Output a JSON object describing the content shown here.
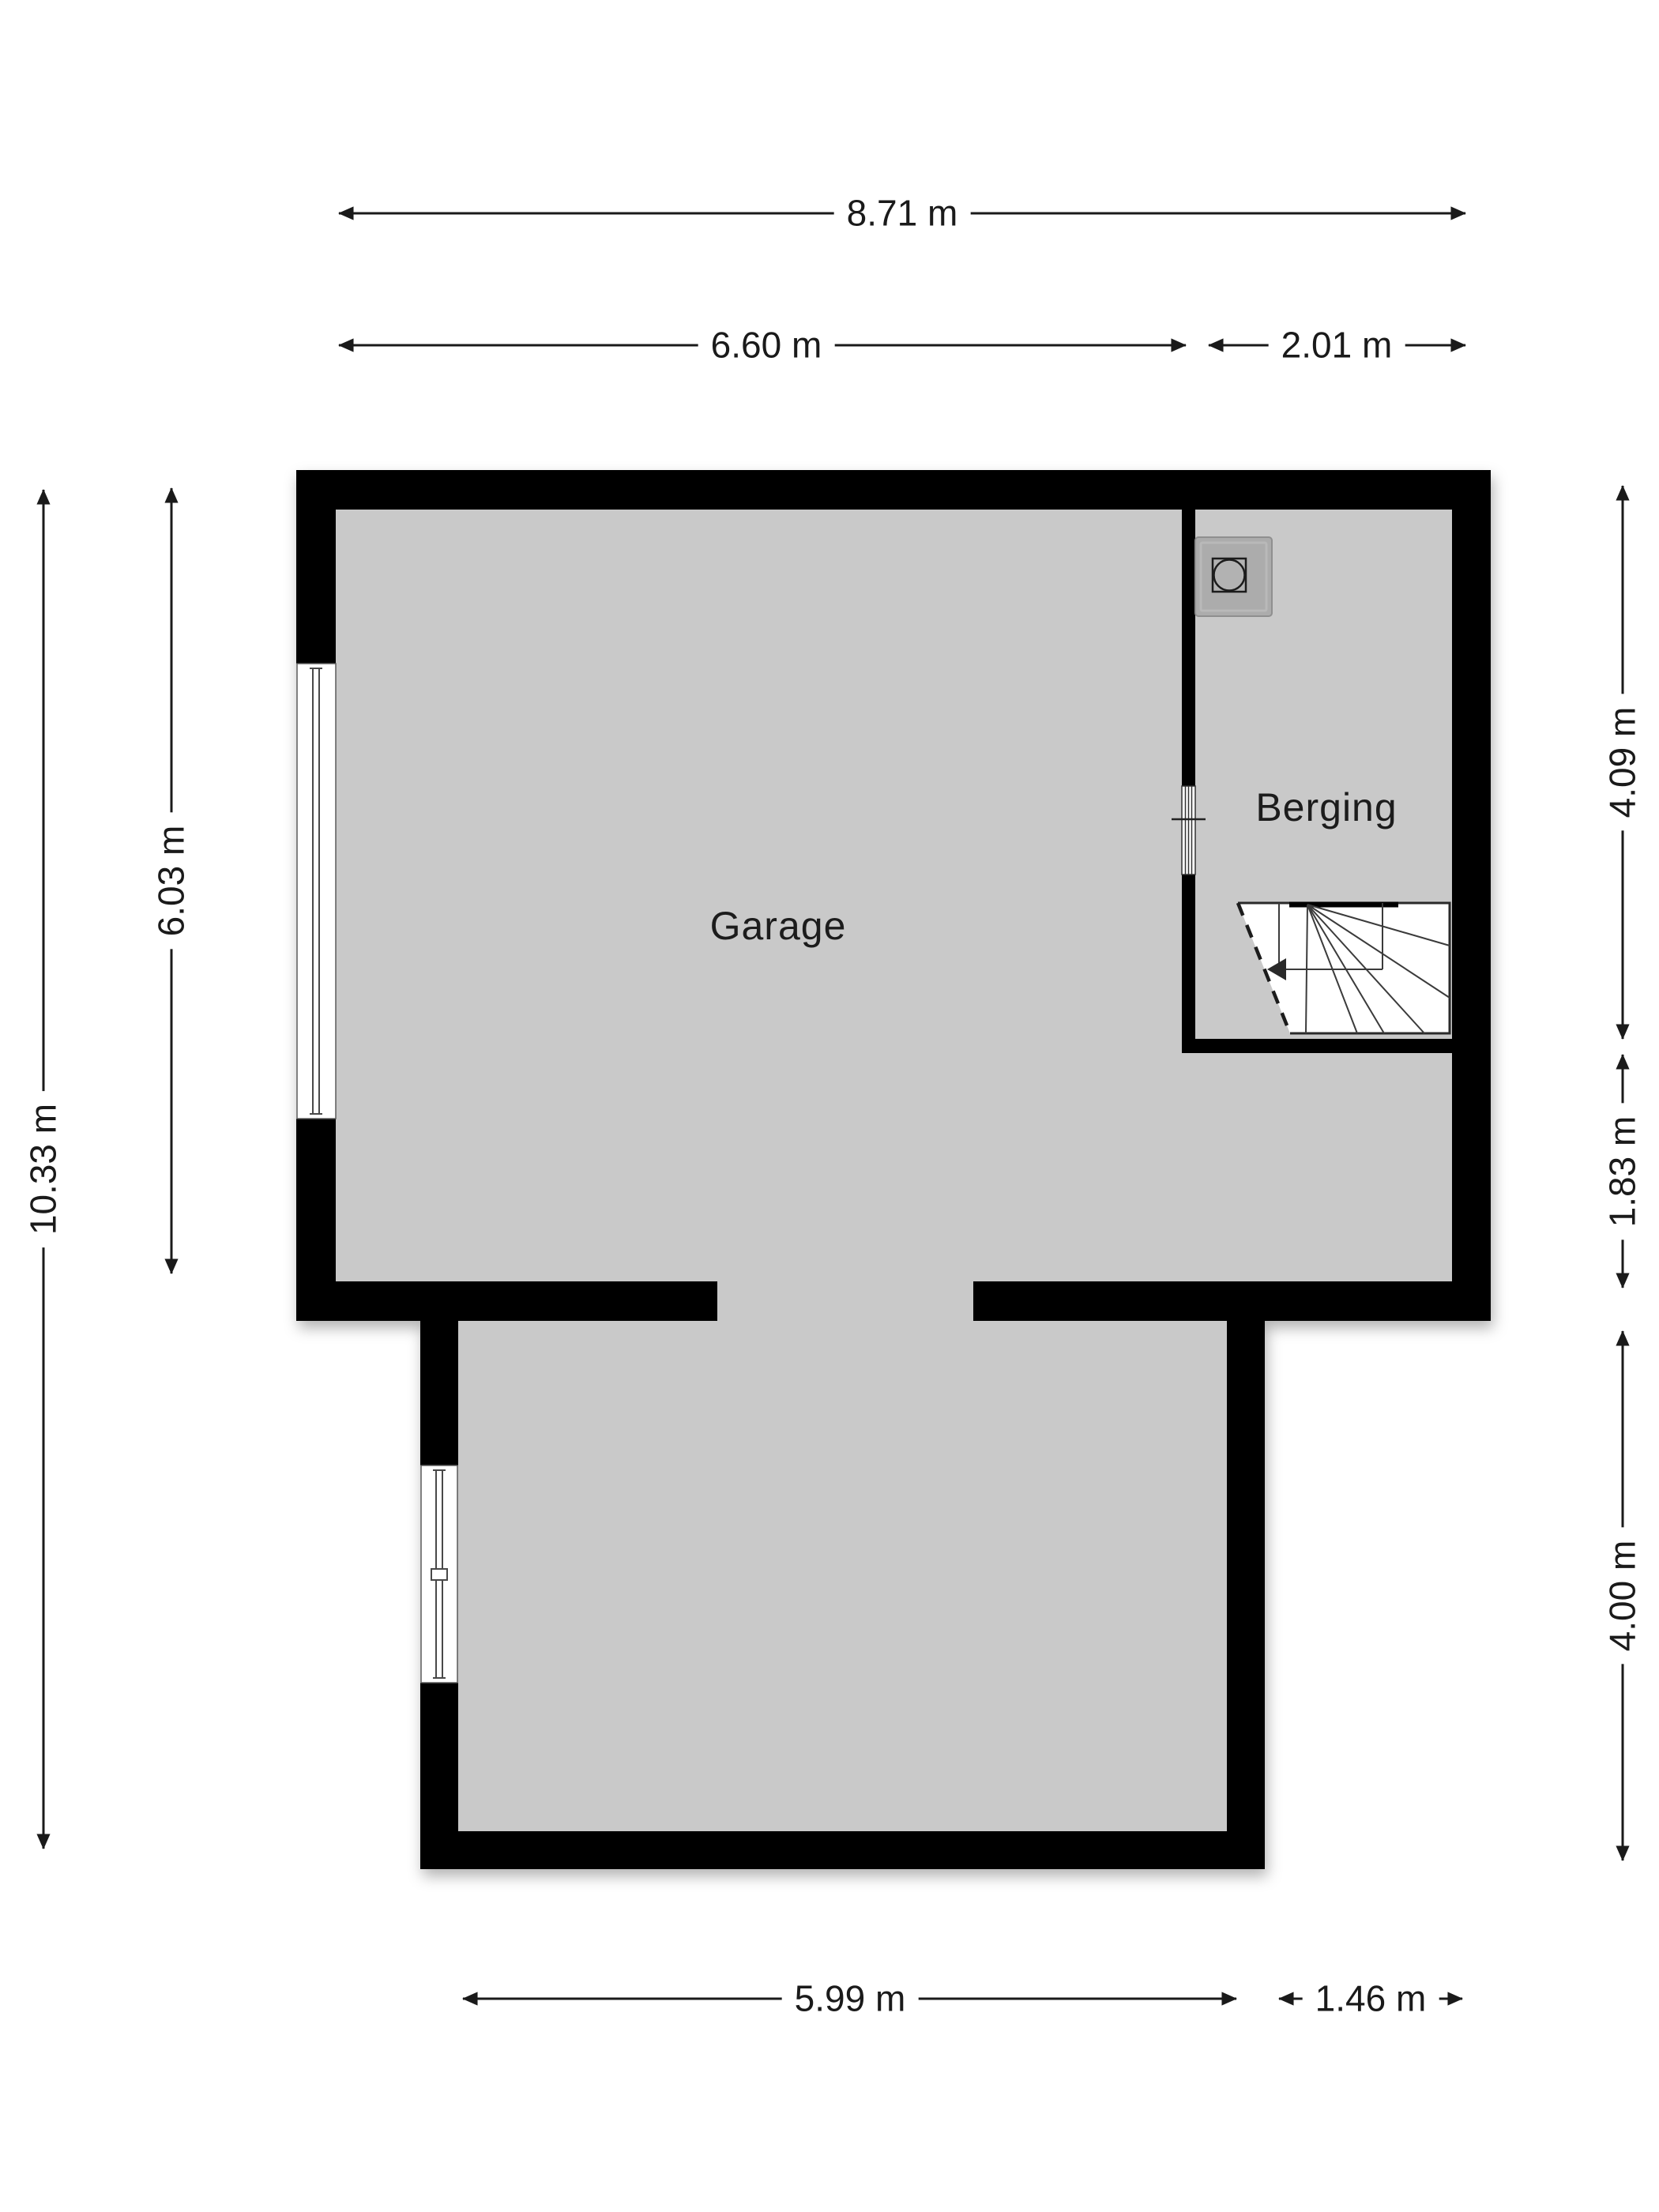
{
  "plan": {
    "type": "floorplan",
    "rooms": [
      {
        "name": "Garage"
      },
      {
        "name": "Berging"
      }
    ],
    "icons": [
      {
        "name": "washing-machine-icon",
        "shape": "square-with-circle"
      },
      {
        "name": "stairs-icon",
        "shape": "winder-stairs-with-direction-arrow"
      },
      {
        "name": "window-icon",
        "shape": "double-line-glazing"
      },
      {
        "name": "door-icon",
        "shape": "striped-opening"
      }
    ],
    "dimensions": {
      "top_total": "8.71 m",
      "top_garage": "6.60 m",
      "top_berging": "2.01 m",
      "left_garage": "6.03 m",
      "left_total": "10.33 m",
      "right_berging": "4.09 m",
      "right_strip": "1.83 m",
      "right_lower": "4.00 m",
      "bottom_lower": "5.99 m",
      "bottom_right": "1.46 m"
    }
  },
  "colors": {
    "wall": "#000000",
    "floor": "#c9c9c9",
    "line": "#1a1a1a",
    "stairs-line": "#3a3a3a",
    "page": "#ffffff"
  }
}
